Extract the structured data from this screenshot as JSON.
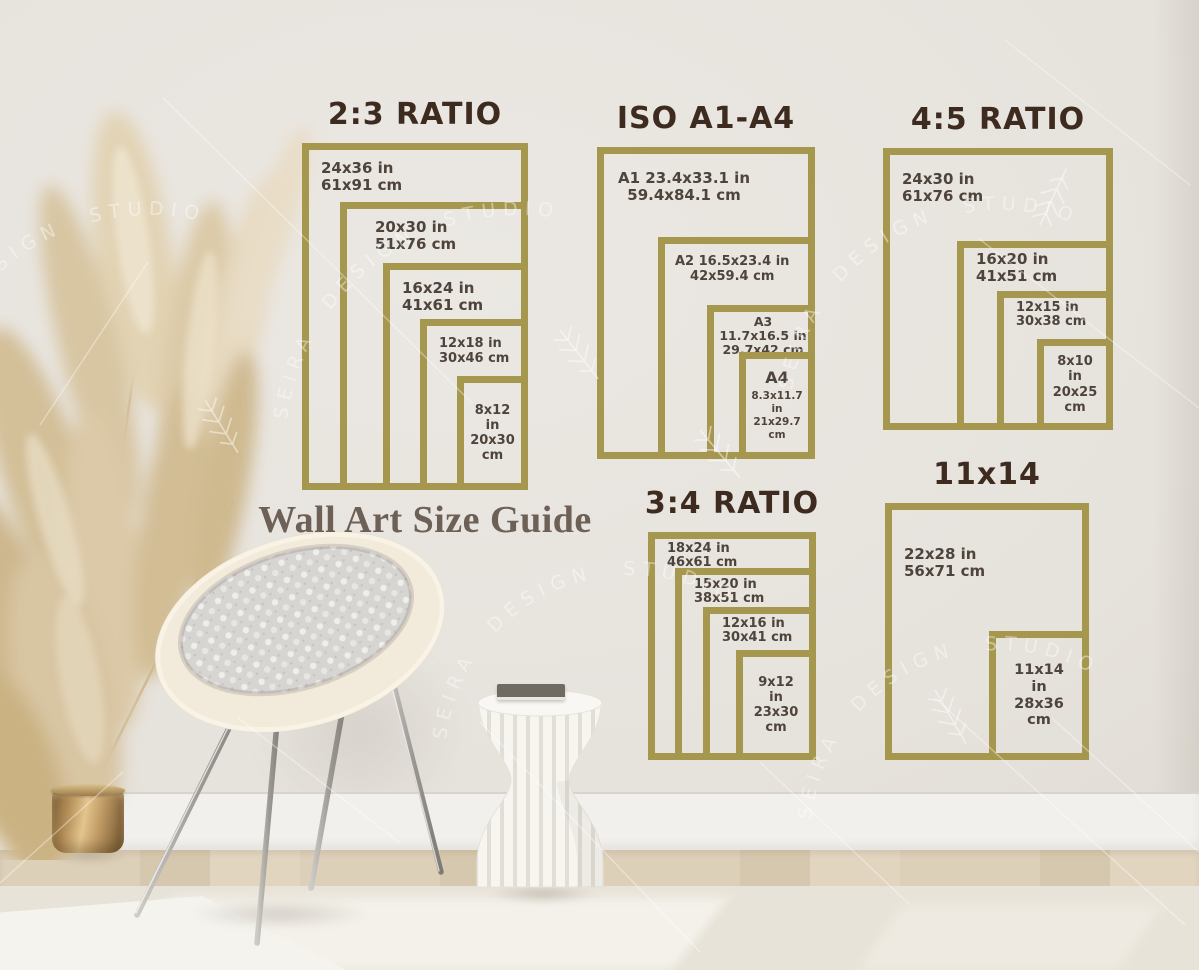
{
  "caption": "Wall Art Size Guide",
  "watermark": {
    "text": "SEIRA DESIGN STUDIO"
  },
  "colors": {
    "frame_gold": "#a6974f",
    "title_brown": "#3e2b20",
    "label_text": "#4e443c",
    "caption_text": "#6d6057",
    "wall": "#e6e2dc",
    "floor_wood": "#dbcfb8",
    "rug": "#e8e3d8",
    "pot_brass": "#b08a54",
    "watermark": "#ffffff"
  },
  "groups": [
    {
      "title": "2:3 RATIO",
      "frames": [
        {
          "in": "24x36 in",
          "cm": "61x91 cm"
        },
        {
          "in": "20x30 in",
          "cm": "51x76 cm"
        },
        {
          "in": "16x24 in",
          "cm": "41x61 cm"
        },
        {
          "in": "12x18 in",
          "cm": "30x46 cm"
        },
        {
          "in": "8x12 in",
          "cm": "20x30 cm"
        }
      ]
    },
    {
      "title": "ISO A1-A4",
      "frames": [
        {
          "in": "A1 23.4x33.1 in",
          "cm": "59.4x84.1 cm"
        },
        {
          "in": "A2 16.5x23.4 in",
          "cm": "42x59.4 cm"
        },
        {
          "in": "A3 11.7x16.5 in",
          "cm": "29.7x42 cm"
        },
        {
          "name": "A4",
          "in": "8.3x11.7 in",
          "cm": "21x29.7 cm"
        }
      ]
    },
    {
      "title": "4:5 RATIO",
      "frames": [
        {
          "in": "24x30 in",
          "cm": "61x76 cm"
        },
        {
          "in": "16x20 in",
          "cm": "41x51 cm"
        },
        {
          "in": "12x15 in",
          "cm": "30x38 cm"
        },
        {
          "in": "8x10 in",
          "cm": "20x25 cm"
        }
      ]
    },
    {
      "title": "3:4 RATIO",
      "frames": [
        {
          "in": "18x24 in",
          "cm": "46x61 cm"
        },
        {
          "in": "15x20 in",
          "cm": "38x51 cm"
        },
        {
          "in": "12x16 in",
          "cm": "30x41 cm"
        },
        {
          "in": "9x12 in",
          "cm": "23x30 cm"
        }
      ]
    },
    {
      "title": "11x14",
      "frames": [
        {
          "in": "22x28 in",
          "cm": "56x71 cm"
        },
        {
          "in": "11x14 in",
          "cm": "28x36 cm"
        }
      ]
    }
  ]
}
